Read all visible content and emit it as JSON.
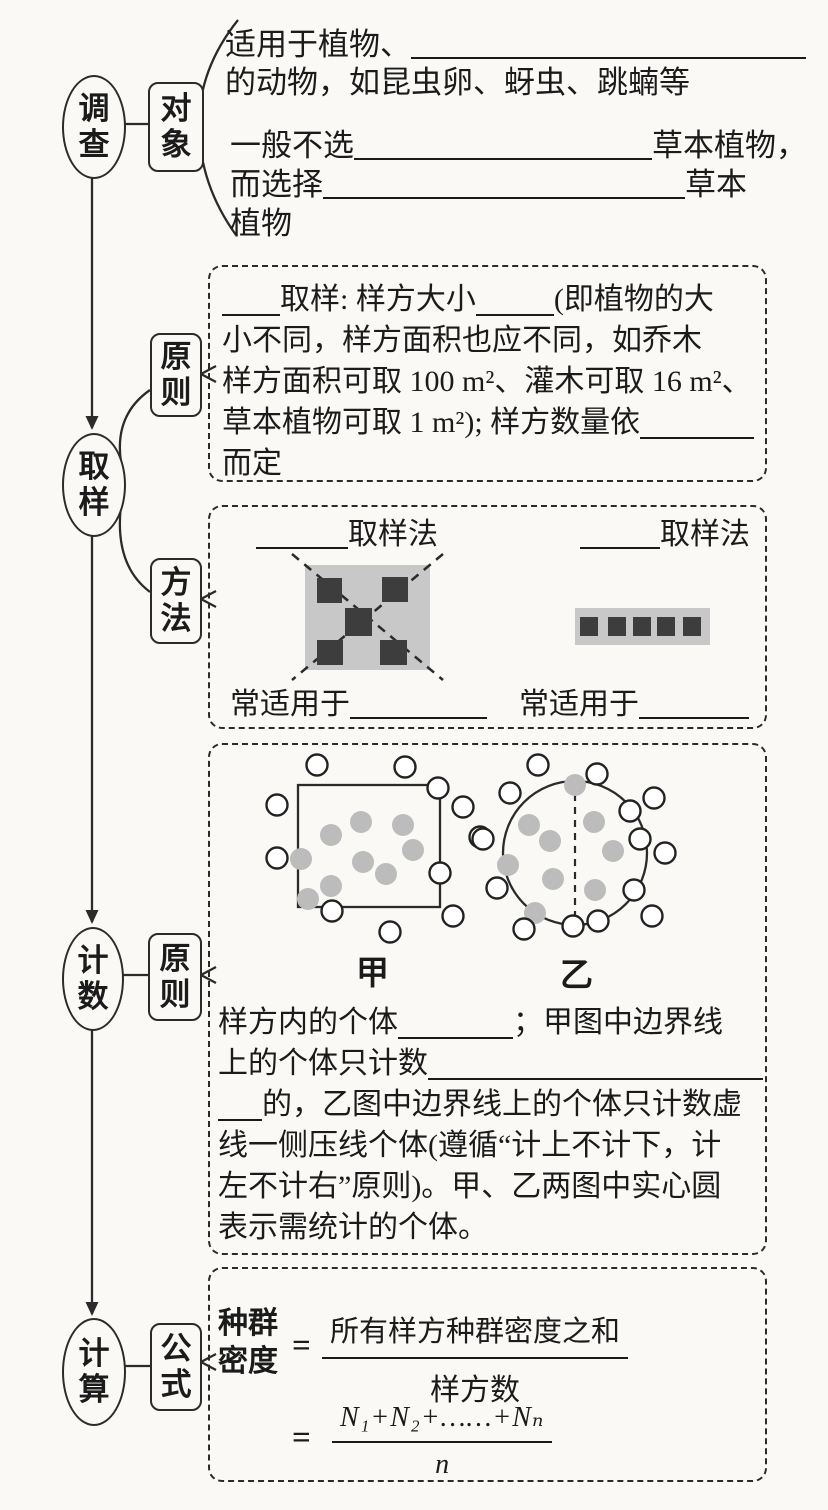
{
  "nodes": {
    "survey": "调查",
    "object": "对象",
    "sampling": "取样",
    "principle1": "原则",
    "method": "方法",
    "counting": "计数",
    "principle2": "原则",
    "calculation": "计算",
    "formula": "公式"
  },
  "object_text": {
    "l1a": "适用于植物、",
    "l2": "的动物，如昆虫卵、蚜虫、跳蝻等",
    "l3a": "一般不选",
    "l3b": "草本植物，",
    "l4a": "而选择",
    "l4b": "草本",
    "l5": "植物"
  },
  "principle_box": {
    "l1a": "取样: 样方大小",
    "l1b": "(即植物的大",
    "l2": "小不同，样方面积也应不同，如乔木",
    "l3": "样方面积可取 100 m²、灌木可取 16 m²、",
    "l4a": "草本植物可取 1 m²); 样方数量依",
    "l5": "而定"
  },
  "method_box": {
    "left_label": "取样法",
    "right_label": "取样法",
    "left_caption": "常适用于",
    "right_caption": "常适用于"
  },
  "counting_box": {
    "jia_label": "甲",
    "yi_label": "乙",
    "l1a": "样方内的个体",
    "l1b": "；甲图中边界线",
    "l2a": "上的个体只计数",
    "l3b": "的，乙图中边界线上的个体只计数虚",
    "l4": "线一侧压线个体(遵循“计上不计下，计",
    "l5": "左不计右”原则)。甲、乙两图中实心圆",
    "l6": "表示需统计的个体。"
  },
  "formula_box": {
    "label_l1": "种群",
    "label_l2": "密度",
    "eq1": "=",
    "num1": "所有样方种群密度之和",
    "den1": "样方数",
    "eq2": "=",
    "num2": "N₁+N₂+……+Nₙ",
    "den2": "n"
  },
  "figures": {
    "jia": {
      "gray_dots": [
        [
          91,
          90
        ],
        [
          121,
          77
        ],
        [
          163,
          80
        ],
        [
          173,
          105
        ],
        [
          61,
          114
        ],
        [
          123,
          117
        ],
        [
          146,
          129
        ],
        [
          91,
          141
        ],
        [
          68,
          154
        ]
      ],
      "white_dots": [
        [
          77,
          20
        ],
        [
          165,
          22
        ],
        [
          198,
          43
        ],
        [
          37,
          60
        ],
        [
          223,
          62
        ],
        [
          240,
          92
        ],
        [
          37,
          113
        ],
        [
          200,
          128
        ],
        [
          92,
          166
        ],
        [
          213,
          171
        ],
        [
          150,
          187
        ]
      ]
    },
    "yi": {
      "gray_dots": [
        [
          335,
          40
        ],
        [
          289,
          80
        ],
        [
          354,
          77
        ],
        [
          310,
          96
        ],
        [
          373,
          106
        ],
        [
          268,
          120
        ],
        [
          313,
          134
        ],
        [
          355,
          145
        ],
        [
          295,
          168
        ]
      ],
      "white_dots": [
        [
          298,
          20
        ],
        [
          357,
          29
        ],
        [
          270,
          48
        ],
        [
          414,
          53
        ],
        [
          390,
          66
        ],
        [
          243,
          94
        ],
        [
          400,
          94
        ],
        [
          425,
          108
        ],
        [
          257,
          143
        ],
        [
          394,
          145
        ],
        [
          412,
          171
        ],
        [
          358,
          176
        ],
        [
          333,
          181
        ],
        [
          284,
          184
        ],
        [
          524,
          184
        ]
      ]
    }
  },
  "colors": {
    "ink": "#1b1b1b",
    "quadrat_gray": "#c8c8c8",
    "dark_square": "#3d3d3d",
    "dot_gray": "#bcbcbc"
  }
}
